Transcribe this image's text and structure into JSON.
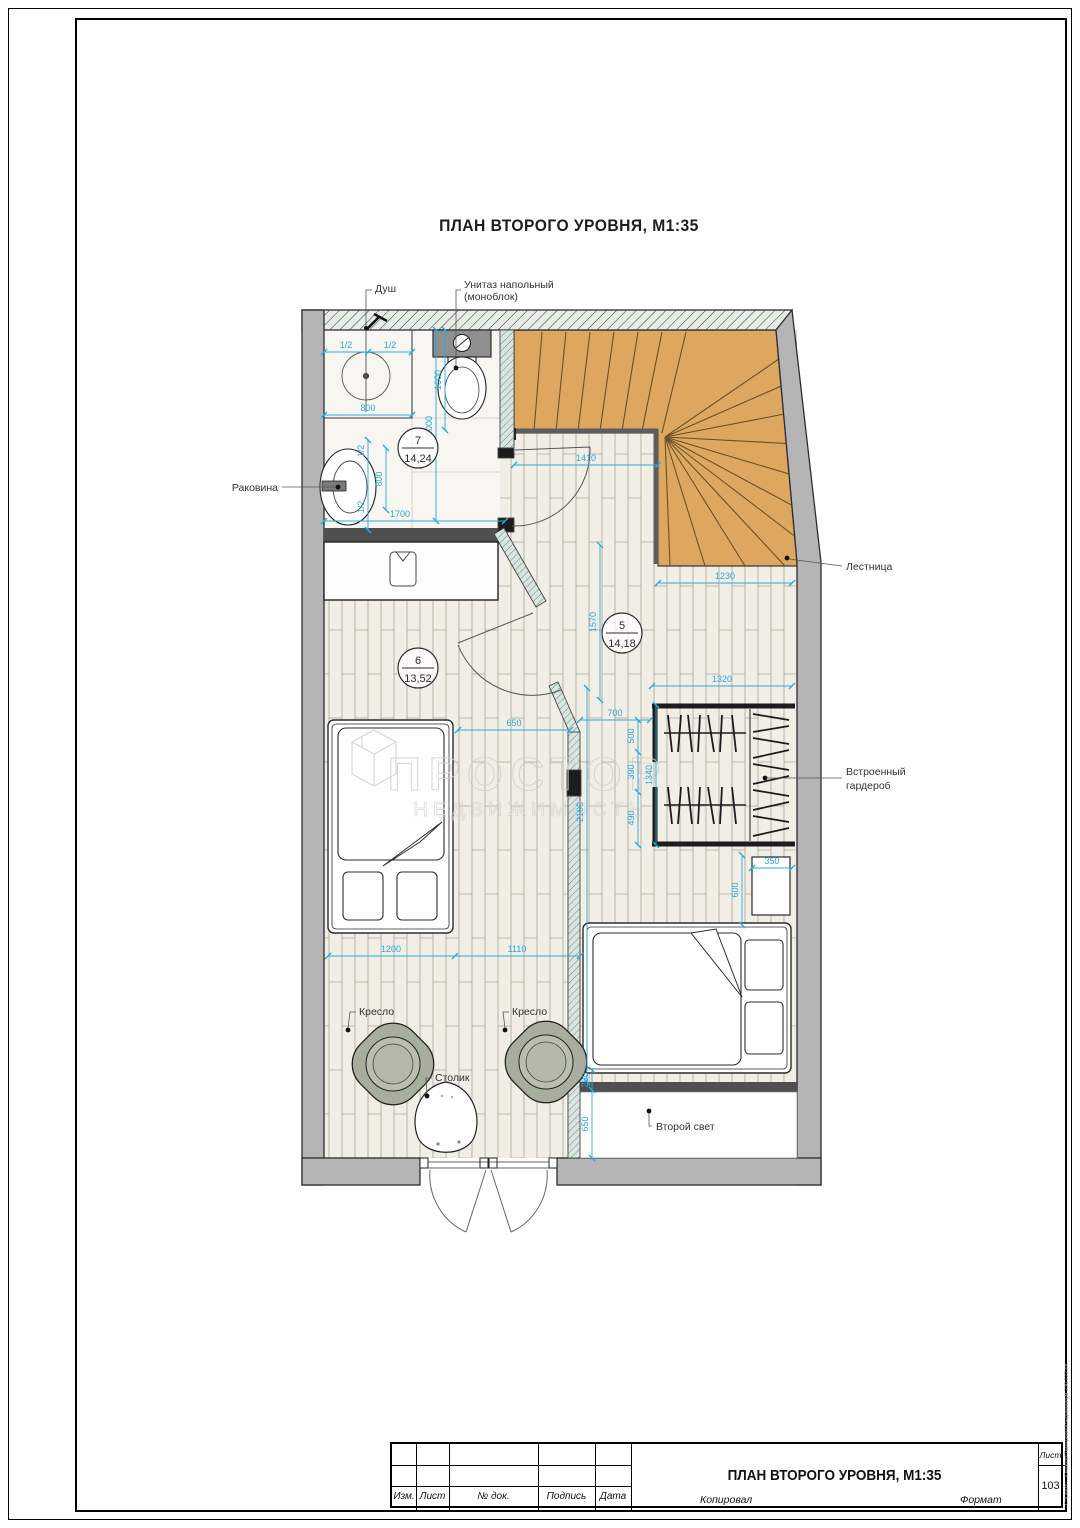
{
  "page": {
    "title": "ПЛАН ВТОРОГО УРОВНЯ, М1:35",
    "file_path": "C:\\Users\\...\\Desktop\\Тамерлан\\Кондоминиум 230.222.rvt"
  },
  "watermark": {
    "brand": "ПРОСТОР",
    "subtitle": "НЕДВИЖИМОСТЬ"
  },
  "labels": {
    "shower": "Душ",
    "toilet_line1": "Унитаз напольный",
    "toilet_line2": "(моноблок)",
    "sink": "Раковина",
    "stairs": "Лестница",
    "wardrobe_line1": "Встроенный",
    "wardrobe_line2": "гардероб",
    "armchair_left": "Кресло",
    "armchair_right": "Кресло",
    "table": "Столик",
    "second_light": "Второй свет"
  },
  "rooms": {
    "r7": {
      "num": "7",
      "area": "14,24"
    },
    "r6": {
      "num": "6",
      "area": "13,52"
    },
    "r5": {
      "num": "5",
      "area": "14,18"
    }
  },
  "dims": {
    "half_a": "1/2",
    "half_b": "1/2",
    "w800": "800",
    "w1000": "1000",
    "w2000": "2000",
    "sink_half_a": "1/2",
    "sink_800": "800",
    "sink_half_b": "1/2",
    "w1700": "1700",
    "w1410": "1410",
    "w1230": "1230",
    "w1570": "1570",
    "w1320": "1320",
    "w650_bed": "650",
    "w700": "700",
    "w500": "500",
    "w390": "390",
    "w490": "490",
    "w1340": "1340",
    "w2100": "2100",
    "w350": "350",
    "w600": "600",
    "w1200": "1200",
    "w1110": "1110",
    "w200": "200",
    "w650_void": "650"
  },
  "title_block": {
    "izm": "Изм.",
    "list": "Лист",
    "doc": "№ док.",
    "podpis": "Подпись",
    "data": "Дата",
    "drawing_title": "ПЛАН ВТОРОГО УРОВНЯ, М1:35",
    "sheet_label": "Лист",
    "sheet_number": "103",
    "kopiroval": "Копировал",
    "format": "Формат"
  },
  "colors": {
    "dimension": "#2BA9E0",
    "stairs": "#DEA75F",
    "wall": "#B5B5B5",
    "chair": "#A7AE9D",
    "glass": "#D7E6DF"
  }
}
